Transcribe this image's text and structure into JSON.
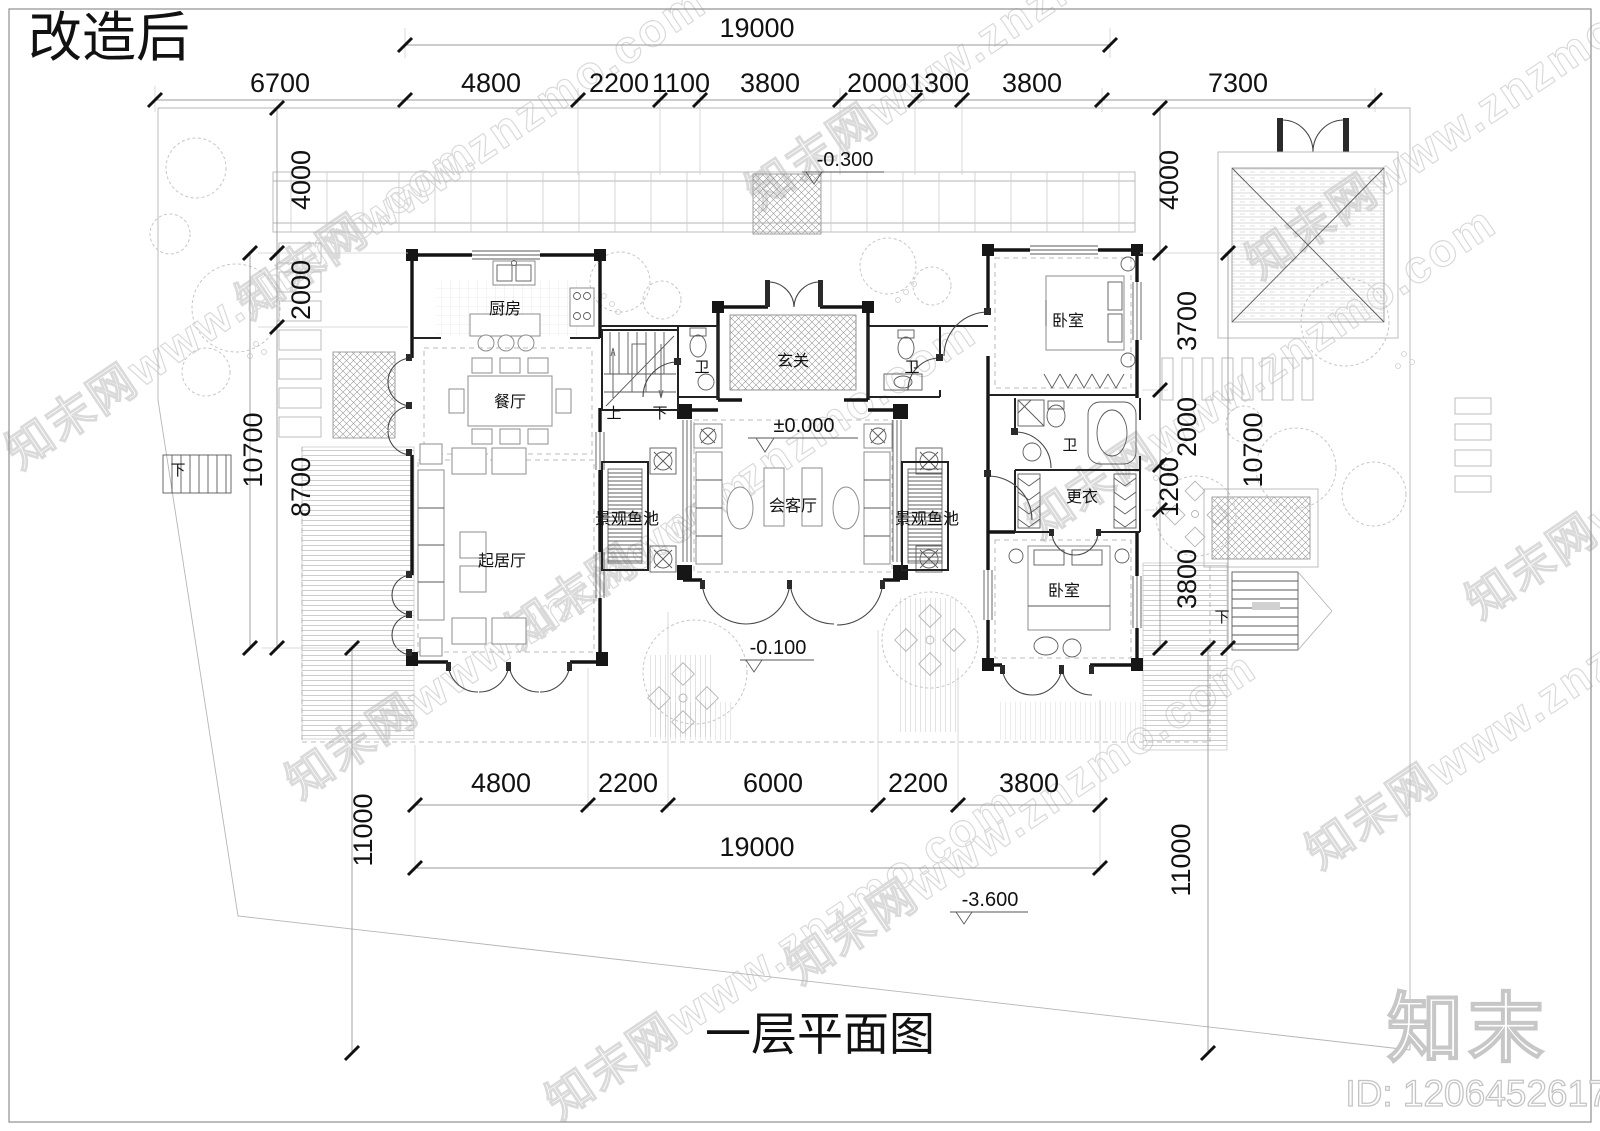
{
  "sheet": {
    "revision_title": "改造后",
    "plan_title": "一层平面图"
  },
  "brand": {
    "logo": "知末",
    "id_label": "ID: 1206452617",
    "watermark": "知末网www.znzmo.com"
  },
  "colors": {
    "line": "#141414",
    "light_line": "#b5b5b5",
    "watermark": "#dadada",
    "background": "#ffffff"
  },
  "dims": {
    "top_total": "19000",
    "top": [
      "6700",
      "4800",
      "2200",
      "1100",
      "3800",
      "2000",
      "1300",
      "3800",
      "7300"
    ],
    "left": [
      "4000",
      "2000",
      "10700",
      "8700",
      "11000"
    ],
    "right": [
      "4000",
      "3700",
      "2000",
      "1200",
      "10700",
      "3800",
      "11000"
    ],
    "bottom": [
      "4800",
      "2200",
      "6000",
      "2200",
      "3800"
    ],
    "bottom_total": "19000"
  },
  "levels": {
    "entry_terrace": "-0.300",
    "main_floor": "±0.000",
    "courtyard": "-0.100",
    "site_low": "-3.600"
  },
  "rooms": {
    "kitchen": "厨房",
    "dining": "餐厅",
    "living": "起居厅",
    "foyer": "玄关",
    "reception": "会客厅",
    "bedroom_top": "卧室",
    "bedroom_bottom": "卧室",
    "closet": "更衣",
    "bath_left": "卫",
    "bath_center": "卫",
    "bath_right": "卫",
    "pond_left": "景观鱼池",
    "pond_right": "景观鱼池"
  },
  "stairs": {
    "up": "上",
    "down": "下",
    "down_left": "下",
    "down_right": "下"
  }
}
